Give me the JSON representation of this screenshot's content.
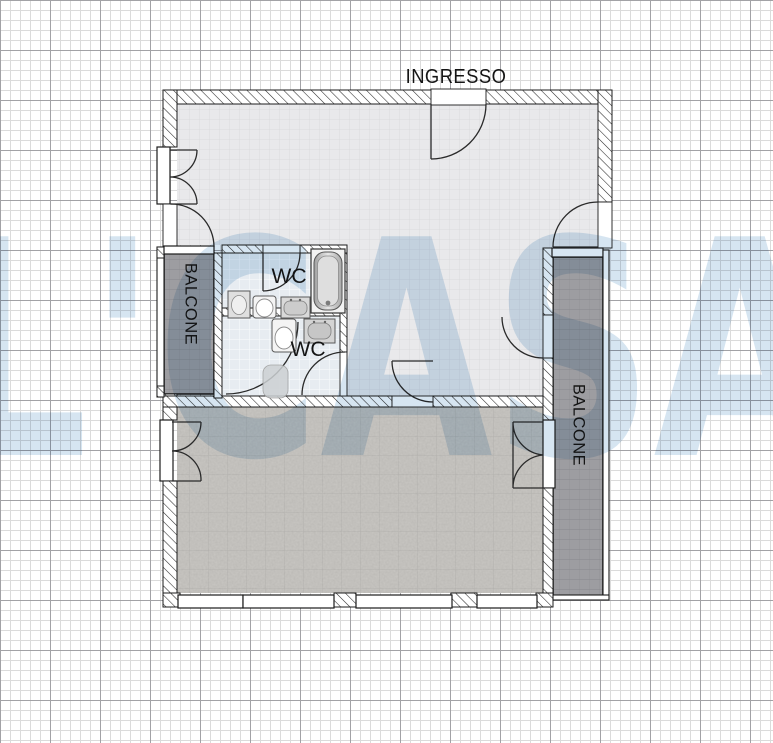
{
  "plan": {
    "entrance_label": "INGRESSO",
    "wc_top_label": "WC",
    "wc_bottom_label": "WC",
    "balcony_left_label": "BALCONE",
    "balcony_right_label": "BALCONE"
  },
  "watermark": {
    "text": "L'CASA"
  },
  "colors": {
    "grid_minor": "#dbdbdb",
    "grid_major": "#a2a2a6",
    "wall_stroke": "#1c1c1c",
    "hatch_line": "#2a2a2a",
    "floor_main": "#e9e9eb",
    "floor_main_line": "#dadadd",
    "floor_wc": "#e7ecf1",
    "floor_wc_line": "#f7f9fb",
    "floor_bottom": "#c9c7c3",
    "balcony_fill": "#9d9da1",
    "balcony_line": "#8a8a8f",
    "door_stroke": "#2a2a2a",
    "label_color": "#151515",
    "watermark_color": "#b5d0e6"
  }
}
